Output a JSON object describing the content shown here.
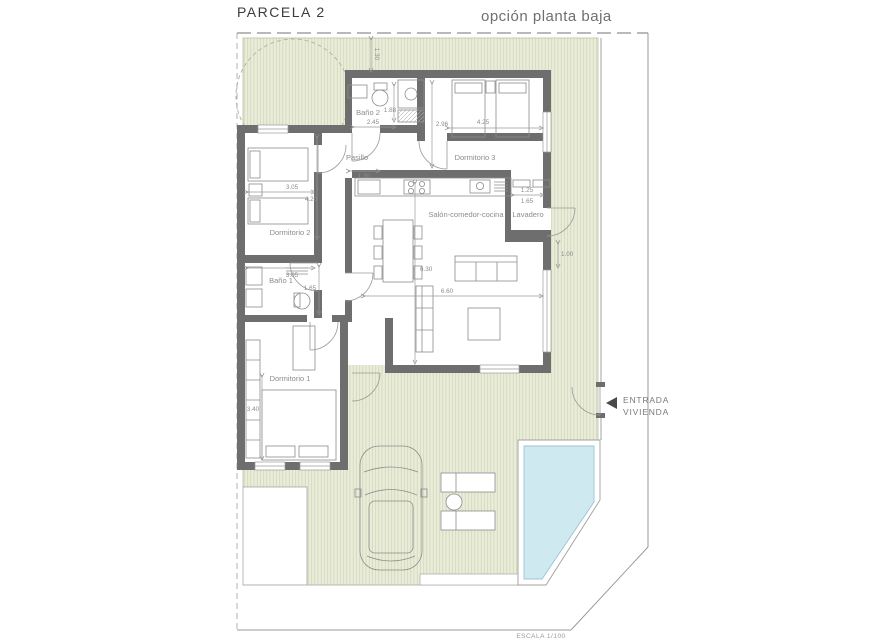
{
  "header": {
    "title": "PARCELA 2",
    "subtitle": "opción planta baja"
  },
  "footer": {
    "scale_label": "ESCALA 1/100"
  },
  "entrance": {
    "arrow_icon": "left-triangle-arrow",
    "line1": "ENTRADA",
    "line2": "VIVIENDA"
  },
  "rooms": {
    "bano2": "Baño 2",
    "pasillo": "Pasillo",
    "dorm3": "Dormitorio 3",
    "dorm2": "Dormitorio 2",
    "salon": "Salón-comedor-cocina",
    "lavadero": "Lavadero",
    "bano1": "Baño 1",
    "dorm1": "Dormitorio 1"
  },
  "dimensions": {
    "top_setback": "1.30",
    "bano2_width": "2.45",
    "bano2_depth": "1.88",
    "dorm3_depth": "2.96",
    "dorm3_width": "4.25",
    "dorm2_width": "3.05",
    "dorm2_depth": "4.20",
    "pasillo_width": "1.30",
    "lavadero_width_a": "1.25",
    "lavadero_width_b": "1.65",
    "salon_depth": "6.30",
    "salon_width": "6.60",
    "side_setback": "1.00",
    "bano1_width": "3.05",
    "bano1_depth": "1.65",
    "dorm1_depth": "3.40"
  },
  "colors": {
    "garden_fill": "#eaedda",
    "garden_hatch": "#ccd3b3",
    "wall": "#6e6e6e",
    "pool_water": "#cfe9f1",
    "thin_line": "#9a9a9a"
  }
}
